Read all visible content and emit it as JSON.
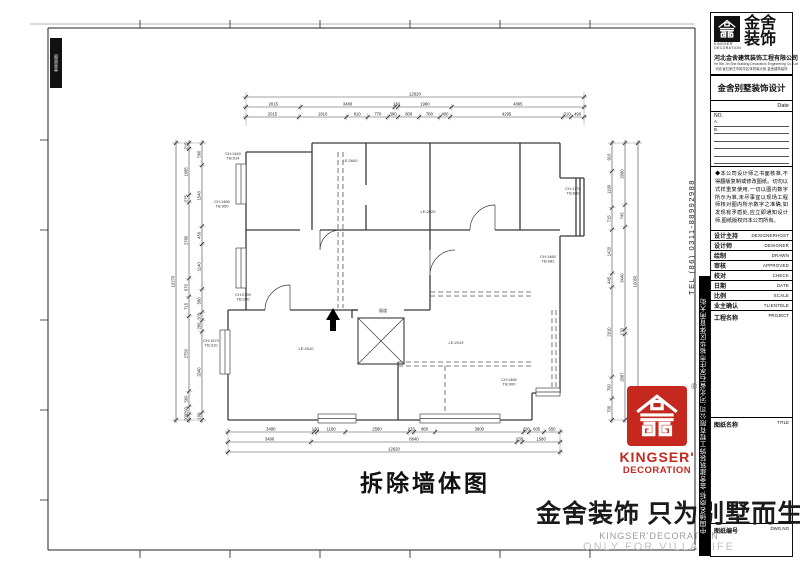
{
  "plan": {
    "title": "拆除墙体图",
    "labels": [
      {
        "t": "CH:1440\nTB:914",
        "x": 233,
        "y": 155
      },
      {
        "t": "LE:2600",
        "x": 350,
        "y": 162
      },
      {
        "t": "LE:2020",
        "x": 428,
        "y": 213
      },
      {
        "t": "CH:1770\nTB:600",
        "x": 573,
        "y": 190
      },
      {
        "t": "CH:1480\nTB:950",
        "x": 222,
        "y": 203
      },
      {
        "t": "CH:1480\nTB:982",
        "x": 548,
        "y": 258
      },
      {
        "t": "CH:2190\nTB:200",
        "x": 243,
        "y": 296
      },
      {
        "t": "CH:1570\nTB:310",
        "x": 211,
        "y": 342
      },
      {
        "t": "LE:2610",
        "x": 306,
        "y": 350
      },
      {
        "t": "LE:2019",
        "x": 456,
        "y": 344
      },
      {
        "t": "烟道",
        "x": 383,
        "y": 312
      },
      {
        "t": "CH:1480\nTB:900",
        "x": 509,
        "y": 381
      }
    ]
  },
  "dimensions": {
    "top": [
      [
        "12620"
      ],
      [
        "2015",
        "3480",
        "130",
        "1980",
        "4895"
      ],
      [
        "2015",
        "1810",
        "810",
        "770",
        "390",
        "800",
        "780",
        "400",
        "4295",
        "310",
        "490"
      ]
    ],
    "bottom": [
      [
        "3490",
        "130",
        "1160",
        "2580",
        "215",
        "860",
        "3600",
        "230",
        "605",
        "650"
      ],
      [
        "3490",
        "8640",
        "235",
        "1580"
      ],
      [
        "12620"
      ]
    ],
    "left": [
      [
        "10270"
      ],
      [
        "215",
        "1685",
        "275",
        "2780",
        "670",
        "715",
        "2750",
        "560",
        "290",
        "200"
      ],
      [
        "560",
        "1540",
        "450",
        "1140",
        "580",
        "205",
        "280",
        "2040",
        "190"
      ]
    ],
    "right": [
      [
        "910",
        "1190",
        "715",
        "1420",
        "445",
        "2910",
        "700",
        "700"
      ],
      [
        "2080",
        "745",
        "3440",
        "170",
        "2887"
      ],
      [
        "10050"
      ]
    ]
  },
  "watermark": {
    "cn": "金舍装饰 只为别墅而生。",
    "en1": "KINGSER'DECORATION",
    "en2": "ONLY FOR VILLA LIFE"
  },
  "stamp": {
    "line1": "KINGSER'",
    "line2": "DECORATION",
    "reg": "®"
  },
  "sidebar": {
    "tel": "TEL (86) 0311-88992988",
    "bar_text": "中国驰名商标·金舍建筑装饰工程有限公司·河北省石家庄市裕华区体育南大街"
  },
  "corner_stamp": {
    "text": "金舍装饰"
  },
  "titleblock": {
    "logo_cn1": "金舍",
    "logo_cn2": "装饰",
    "logo_en1": "KINGSER'",
    "logo_en2": "DECORATION",
    "company": "河北金舍建筑装饰工程有限公司",
    "company_en": "He Bei Jin She Building Decoration Engineering Co.,Ltd",
    "company_sub": "河北省石家庄市裕华区体育南大街 金舍建筑装饰",
    "series": "金舍别墅装饰设计",
    "date_label": "Date",
    "no_label": "NO.",
    "list_rows": [
      "A.",
      "B."
    ],
    "notice": "◆本公司设计师之书面核准,不得翻版复制或修改图纸。切勿以式样重复使用,一切以图内数字所示为准,未尽事宜以现场工程师核对图内所示数字之准确,如发现有矛盾处,应立即通知设计师,图纸版权归本公司所有。",
    "rows": [
      {
        "cn": "设计主持",
        "en": "DESIGNERHOST"
      },
      {
        "cn": "设计师",
        "en": "DESIGNER"
      },
      {
        "cn": "绘制",
        "en": "DRAWN"
      },
      {
        "cn": "审核",
        "en": "APPROVED"
      },
      {
        "cn": "校对",
        "en": "CHECK"
      },
      {
        "cn": "日期",
        "en": "DATE"
      },
      {
        "cn": "比例",
        "en": "SCALE"
      },
      {
        "cn": "业主确认",
        "en": "TLIENTELE"
      }
    ],
    "big_rows": [
      {
        "cn": "工程名称",
        "en": "PROJECT"
      },
      {
        "cn": "图纸名称",
        "en": "TITLE"
      },
      {
        "cn": "图纸编号",
        "en": "DWG.NO"
      }
    ]
  }
}
